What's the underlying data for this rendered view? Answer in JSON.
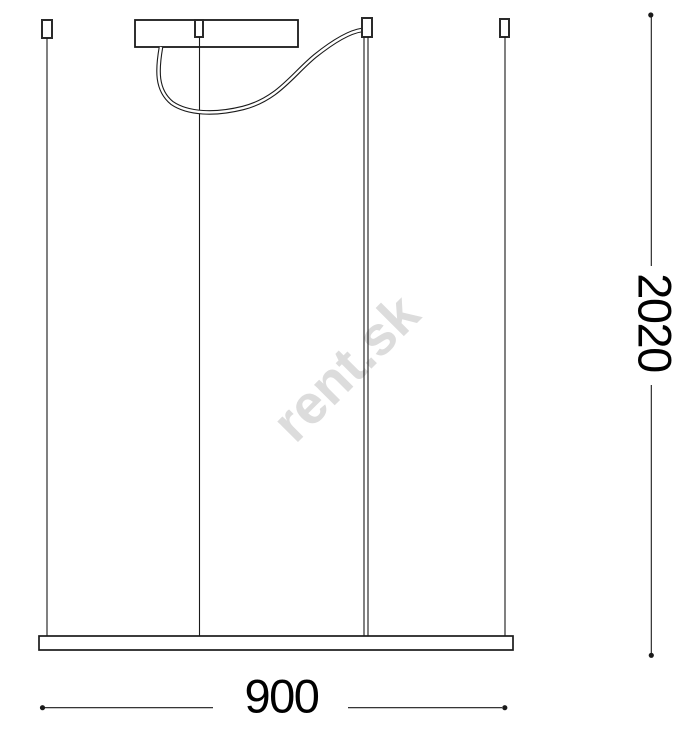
{
  "watermark": "rent.sk",
  "dimensions": {
    "width_label": "900",
    "height_label": "2020"
  },
  "colors": {
    "line": "#1a1a1a",
    "dimension_text": "#000000",
    "watermark": "#dcdcdc",
    "background": "#ffffff"
  }
}
